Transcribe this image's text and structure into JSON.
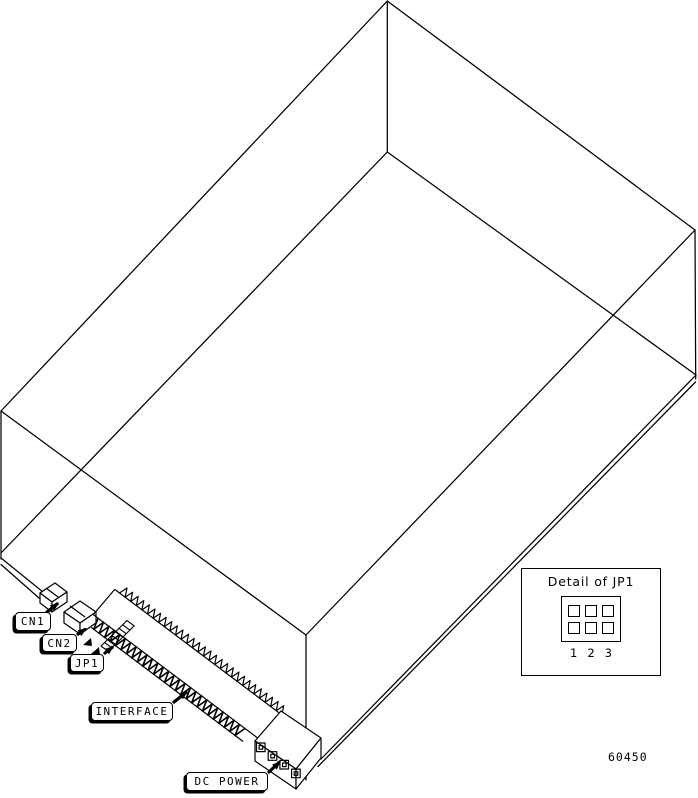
{
  "figure": {
    "description": "isometric-line-drawing-of-disk-drive-with-connector-callouts",
    "part_number": "60450",
    "detail_panel": {
      "title": "Detail of JP1",
      "pin_labels": [
        "1",
        "2",
        "3"
      ]
    },
    "callouts": [
      {
        "id": "cn1",
        "label": "CN1"
      },
      {
        "id": "cn2",
        "label": "CN2"
      },
      {
        "id": "jp1",
        "label": "JP1"
      },
      {
        "id": "interface",
        "label": "INTERFACE"
      },
      {
        "id": "dc_power",
        "label": "DC POWER"
      }
    ],
    "colors": {
      "line": "#000000",
      "background": "#ffffff"
    }
  }
}
